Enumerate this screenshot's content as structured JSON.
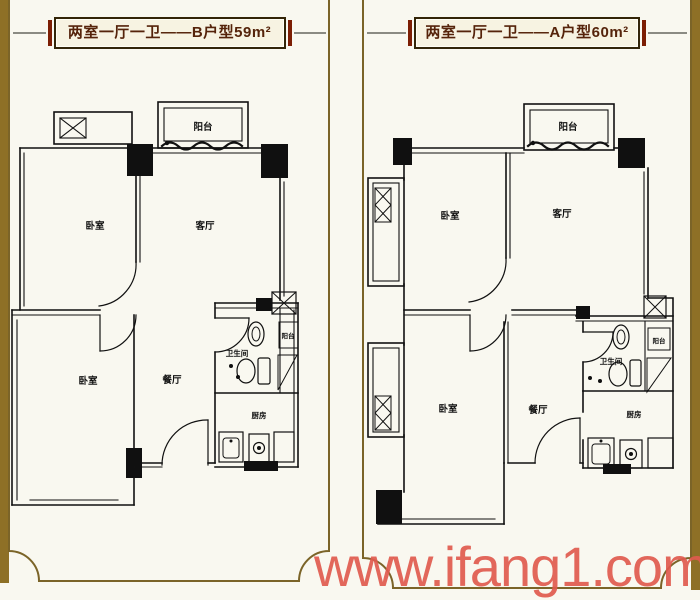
{
  "watermark": {
    "text": "www.ifang1.com",
    "color": "#df5a4e"
  },
  "frame": {
    "border_color": "#7b6428",
    "stripe_color": "#8e7026",
    "background": "#f9f8f0"
  },
  "banner": {
    "bar_color": "#7c1e04",
    "text_color": "#55230a",
    "box_background": "#f7f3e2"
  },
  "plans": [
    {
      "id": "B",
      "title": "两室一厅一卫——B户型59m²",
      "rooms": {
        "balcony_top": "阳台",
        "bedroom_upper": "卧室",
        "living": "客厅",
        "bedroom_lower": "卧室",
        "dining": "餐厅",
        "bathroom": "卫生间",
        "kitchen": "厨房",
        "balcony_side": "阳台"
      }
    },
    {
      "id": "A",
      "title": "两室一厅一卫——A户型60m²",
      "rooms": {
        "balcony_top": "阳台",
        "bedroom_upper": "卧室",
        "living": "客厅",
        "bedroom_lower": "卧室",
        "dining": "餐厅",
        "bathroom": "卫生间",
        "kitchen": "厨房",
        "balcony_side": "阳台"
      }
    }
  ]
}
